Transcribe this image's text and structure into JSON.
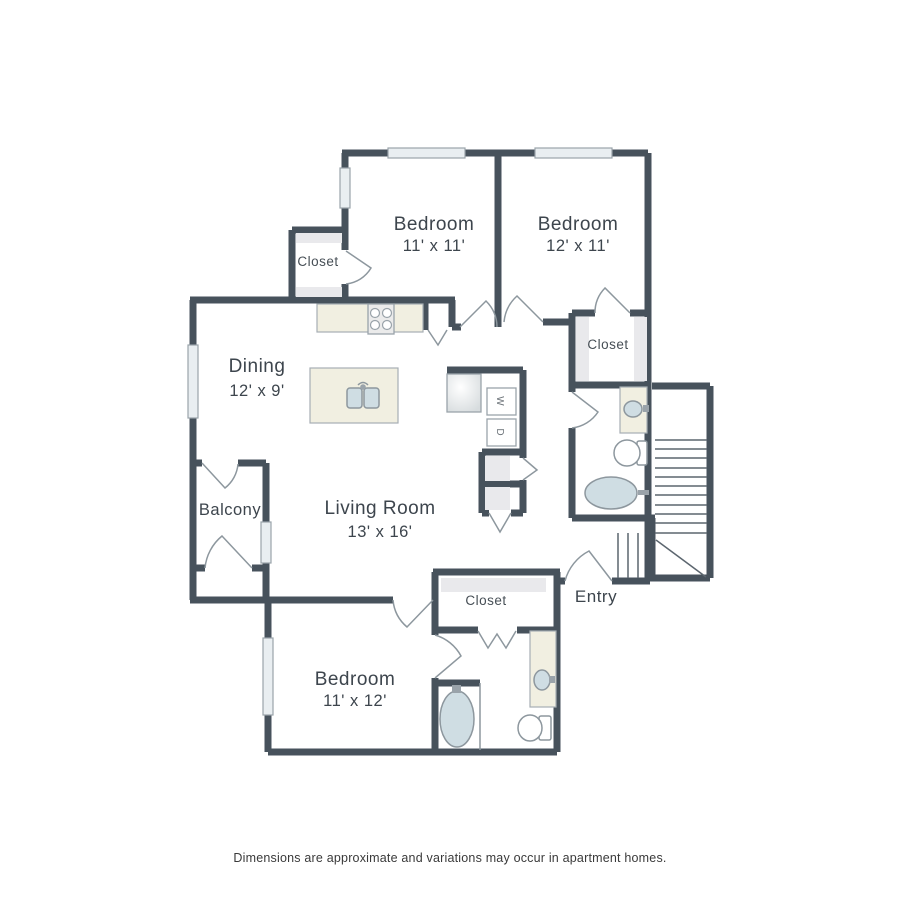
{
  "rooms": {
    "bedroom_top_left": {
      "label": "Bedroom",
      "dims": "11' x 11'"
    },
    "bedroom_top_right": {
      "label": "Bedroom",
      "dims": "12' x 11'"
    },
    "bedroom_bottom": {
      "label": "Bedroom",
      "dims": "11' x 12'"
    },
    "dining": {
      "label": "Dining",
      "dims": "12' x 9'"
    },
    "living_room": {
      "label": "Living Room",
      "dims": "13' x 16'"
    },
    "balcony": {
      "label": "Balcony"
    },
    "entry": {
      "label": "Entry"
    },
    "closet_upper_left": {
      "label": "Closet"
    },
    "closet_right": {
      "label": "Closet"
    },
    "closet_lower": {
      "label": "Closet"
    }
  },
  "appliances": {
    "washer": "W",
    "dryer": "D"
  },
  "footer": {
    "disclaimer": "Dimensions are approximate and variations may occur in apartment homes."
  },
  "colors": {
    "wall": "#47525c",
    "thin_line": "#8d979e",
    "window_fill": "#e9eef1",
    "counter_fill": "#f1efe1",
    "fixture_fill": "#cfdde3",
    "shelf_fill": "#e9e9ec",
    "text": "#3d454d",
    "background": "#ffffff"
  }
}
